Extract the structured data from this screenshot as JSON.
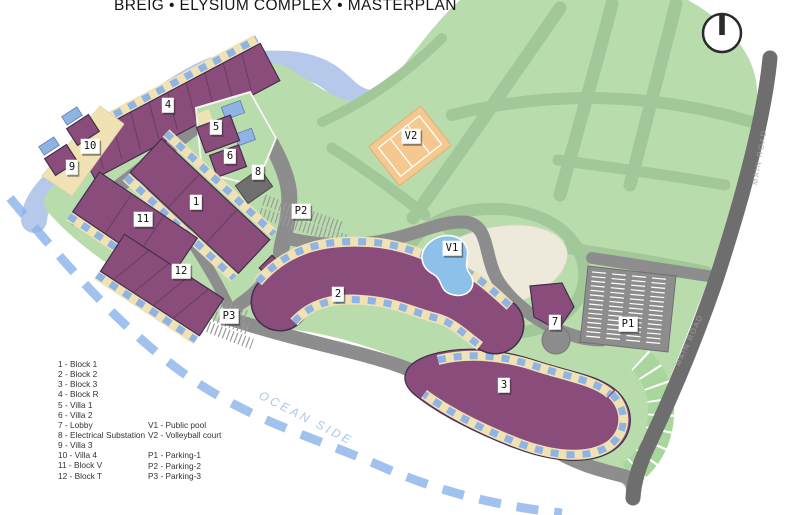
{
  "title": "BREIG • ELYSIUM COMPLEX • MASTERPLAN",
  "map": {
    "ocean_label": "OCEAN SIDE",
    "road_label": "MAIN ROAD",
    "labels": [
      {
        "text": "1",
        "x": 196,
        "y": 202
      },
      {
        "text": "2",
        "x": 338,
        "y": 294
      },
      {
        "text": "3",
        "x": 504,
        "y": 385
      },
      {
        "text": "4",
        "x": 168,
        "y": 105
      },
      {
        "text": "5",
        "x": 216,
        "y": 127
      },
      {
        "text": "6",
        "x": 230,
        "y": 156
      },
      {
        "text": "7",
        "x": 555,
        "y": 322
      },
      {
        "text": "8",
        "x": 258,
        "y": 172
      },
      {
        "text": "9",
        "x": 72,
        "y": 167
      },
      {
        "text": "10",
        "x": 90,
        "y": 146
      },
      {
        "text": "11",
        "x": 143,
        "y": 219
      },
      {
        "text": "12",
        "x": 181,
        "y": 271
      },
      {
        "text": "V1",
        "x": 452,
        "y": 248
      },
      {
        "text": "V2",
        "x": 411,
        "y": 136
      },
      {
        "text": "P1",
        "x": 628,
        "y": 324
      },
      {
        "text": "P2",
        "x": 301,
        "y": 211
      },
      {
        "text": "P3",
        "x": 229,
        "y": 316
      }
    ]
  },
  "legend": {
    "col1": [
      "1 - Block 1",
      "2 - Block 2",
      "3 - Block 3",
      "4 - Block R",
      "5 - Villa 1",
      "6 - Villa 2",
      "7 - Lobby",
      "8 - Electrical Substation",
      "9 - Villa 3",
      "10 - Villa 4",
      "11 - Block V",
      "12 - Block T"
    ],
    "col2": [
      "V1 - Public pool",
      "V2 - Volleyball court",
      "",
      "P1 - Parking-1",
      "P2 - Parking-2",
      "P3 - Parking-3"
    ]
  },
  "colors": {
    "site_green": "#b9dcac",
    "path_sage": "#a2c89a",
    "road_gray": "#8d8d8d",
    "main_road_gray": "#6e6e6e",
    "building_purple": "#8a4c7b",
    "balcony_beige": "#f0e2b4",
    "window_blue": "#8fb4e4",
    "coast_water": "#b7c9ea",
    "ocean_dash_blue": "#89b3ea",
    "court_orange": "#f4c88e",
    "lawn_ivory": "#edeadb",
    "pool_blue": "#8ec1ea"
  }
}
